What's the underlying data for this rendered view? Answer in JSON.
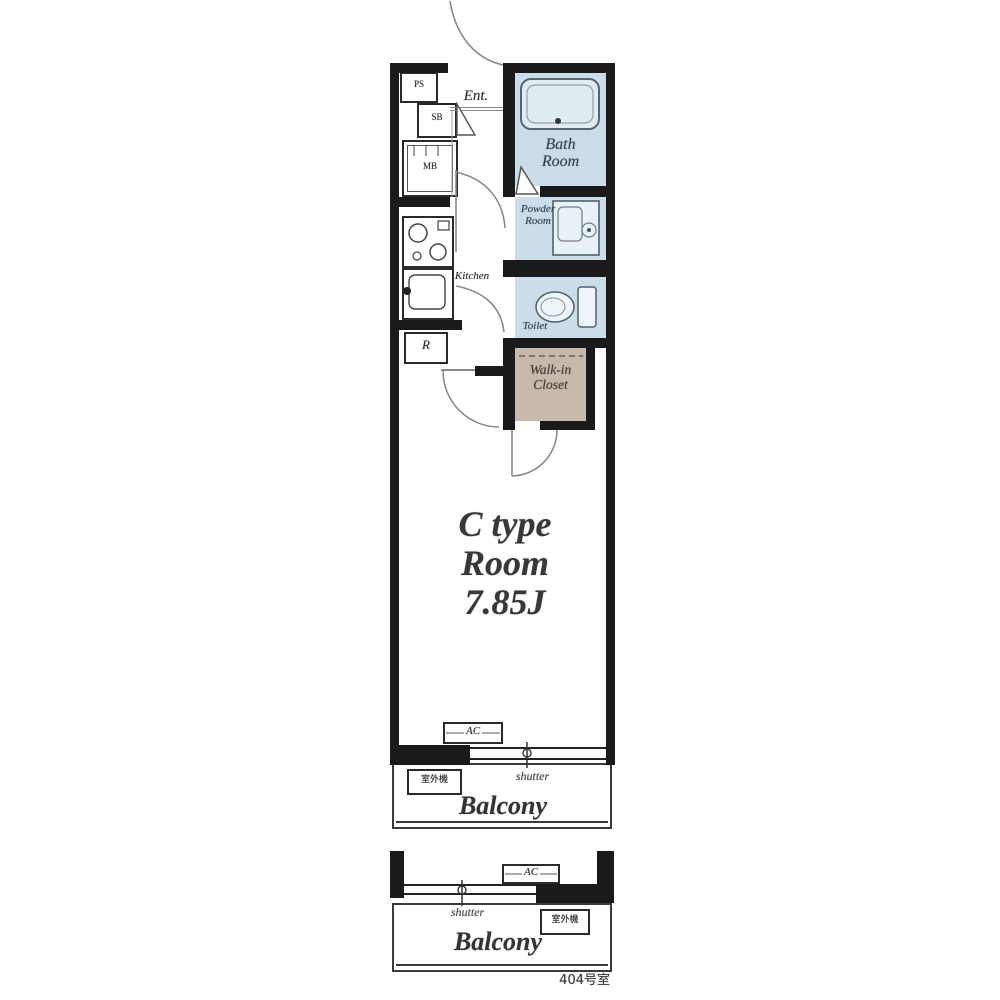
{
  "colors": {
    "wall": "#1a1a1a",
    "wet_area": "#cadde8",
    "walkin_closet": "#c7baac",
    "line": "#888888",
    "background": "#ffffff"
  },
  "labels": {
    "ent": "Ent.",
    "ps": "PS",
    "sb": "SB",
    "mb": "MB",
    "kitchen": "Kitchen",
    "fridge": "R",
    "bath1": "Bath",
    "bath2": "Room",
    "powder1": "Powder",
    "powder2": "Room",
    "toilet": "Toilet",
    "wic1": "Walk-in",
    "wic2": "Closet",
    "room1": "C type",
    "room2": "Room",
    "room3": "7.85J",
    "ac": "AC"
  },
  "balcony_upper": {
    "shutter": "shutter",
    "outdoor_unit": "室外機",
    "label": "Balcony"
  },
  "balcony_lower": {
    "ac": "AC",
    "shutter": "shutter",
    "outdoor_unit": "室外機",
    "label": "Balcony",
    "caption": "404号室"
  }
}
